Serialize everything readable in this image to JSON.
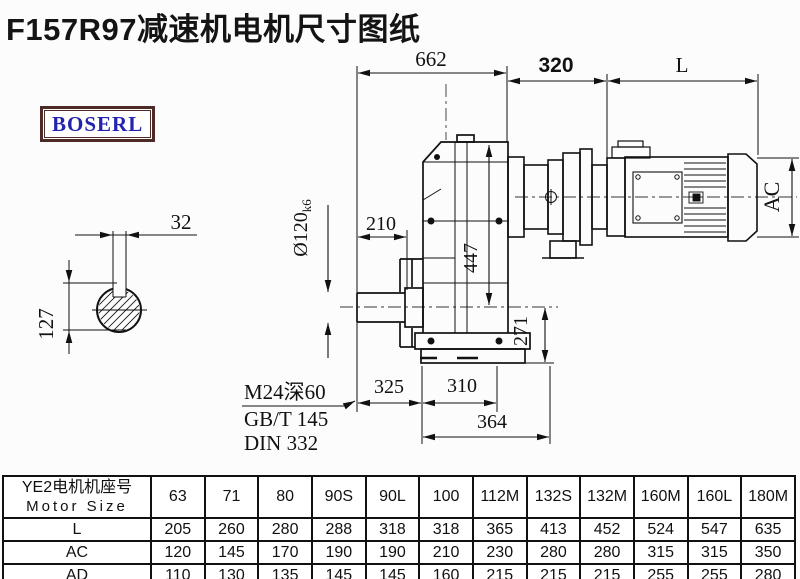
{
  "page": {
    "title": "F157R97减速机电机尺寸图纸",
    "logo_text": "BOSERL"
  },
  "colors": {
    "logo_text_blue": "#2323b0",
    "logo_border_brown": "#4e2b26",
    "line_color": "#111111",
    "title_color": "#141414"
  },
  "drawing": {
    "dims": {
      "d662": "662",
      "d320": "320",
      "dL": "L",
      "d32": "32",
      "d127": "127",
      "d210": "210",
      "shaft_dia": "Ø120",
      "shaft_tol": "k6",
      "d447": "447",
      "d271": "271",
      "d325": "325",
      "d310": "310",
      "d364": "364",
      "dAC": "AC",
      "note_thread": "M24深60",
      "note_gbt": "GB/T 145",
      "note_din": "DIN 332"
    }
  },
  "table": {
    "header_cn": "YE2电机机座号",
    "header_en": "Motor Size",
    "columns": [
      "63",
      "71",
      "80",
      "90S",
      "90L",
      "100",
      "112M",
      "132S",
      "132M",
      "160M",
      "160L",
      "180M"
    ],
    "rows": [
      {
        "label": "L",
        "values": [
          "205",
          "260",
          "280",
          "288",
          "318",
          "318",
          "365",
          "413",
          "452",
          "524",
          "547",
          "635"
        ]
      },
      {
        "label": "AC",
        "values": [
          "120",
          "145",
          "170",
          "190",
          "190",
          "210",
          "230",
          "280",
          "280",
          "315",
          "315",
          "350"
        ]
      },
      {
        "label": "AD",
        "values": [
          "110",
          "130",
          "135",
          "145",
          "145",
          "160",
          "215",
          "215",
          "215",
          "255",
          "255",
          "280"
        ]
      }
    ]
  }
}
